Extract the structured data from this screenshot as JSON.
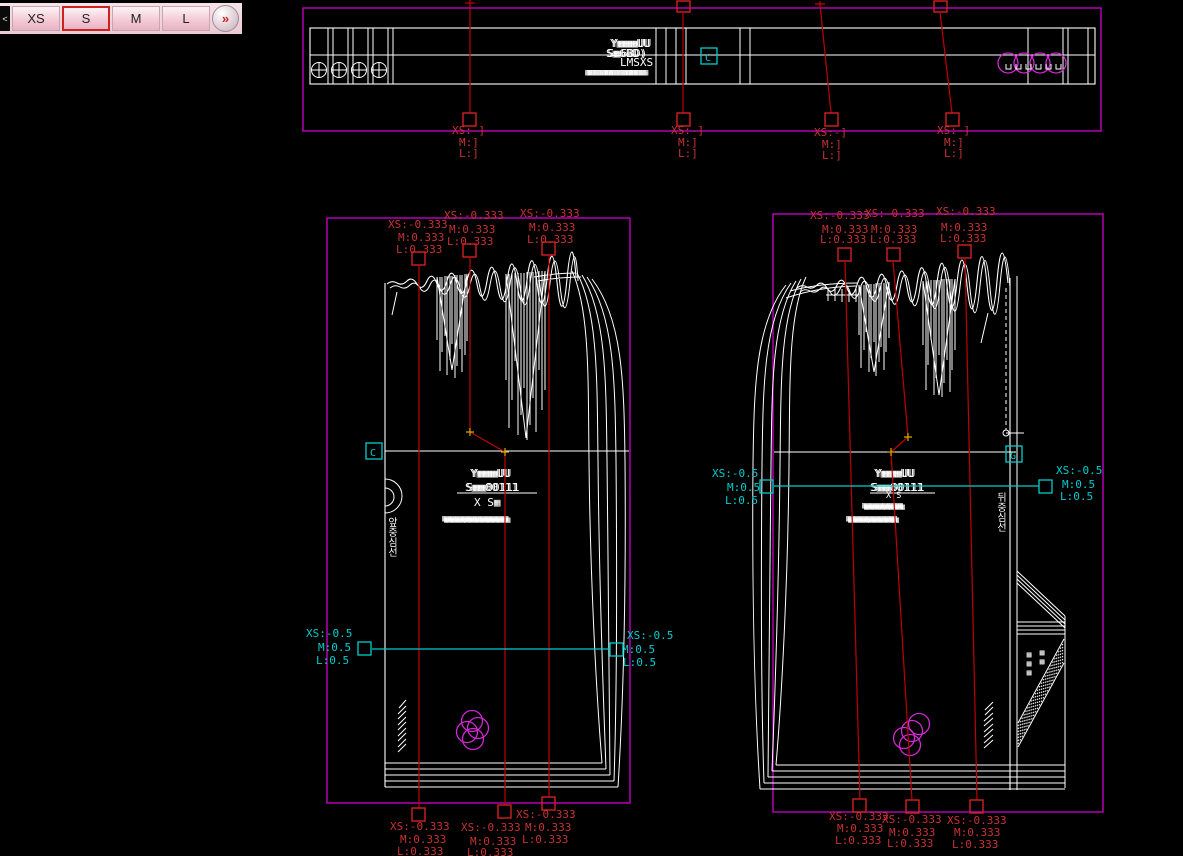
{
  "tabs": {
    "prev": "<",
    "items": [
      {
        "label": "XS",
        "selected": false
      },
      {
        "label": "S",
        "selected": true
      },
      {
        "label": "M",
        "selected": false
      },
      {
        "label": "L",
        "selected": false
      }
    ],
    "more": "»"
  },
  "colors": {
    "background": "#000000",
    "bounding_box_magenta": "#c000c0",
    "ring_magenta": "#d428d4",
    "grade_text_red": "#c83232",
    "grade_line_red": "#c00000",
    "measure_cyan": "#00cdcd",
    "outline_white": "#ffffff",
    "selected_tab_border": "#cc2222"
  },
  "band": {
    "labels": [
      "Y▦▦▦UU",
      "S▦6BD)",
      "LMSXS",
      "▦▦▦▦▦▦▦▦▦▦▦▦"
    ],
    "marker_glyph": "C",
    "grades": [
      {
        "xs": "XS:-]",
        "m": "M:]",
        "l": "L:]"
      },
      {
        "xs": "XS:-]",
        "m": "M:]",
        "l": "L:]"
      },
      {
        "xs": "XS:-]",
        "m": "M:]",
        "l": "L:]"
      },
      {
        "xs": "XS:-]",
        "m": "M:]",
        "l": "L:]"
      }
    ]
  },
  "front": {
    "top_grades": [
      {
        "xs": "XS:-0.333",
        "m": "M:0.333",
        "l": "L:0.333"
      },
      {
        "xs": "XS:-0.333",
        "m": "M:0.333",
        "l": "L:0.333"
      },
      {
        "xs": "XS:-0.333",
        "m": "M:0.333",
        "l": "L:0.333"
      }
    ],
    "bottom_grades": [
      {
        "xs": "XS:-0.333",
        "m": "M:0.333",
        "l": "L:0.333"
      },
      {
        "xs": "XS:-0.333",
        "m": "M:0.333",
        "l": "L:0.333"
      },
      {
        "xs": "XS:-0.333",
        "m": "M:0.333",
        "l": "L:0.333"
      }
    ],
    "left_grade": {
      "xs": "XS:-0.5",
      "m": "M:0.5",
      "l": "L:0.5"
    },
    "right_grade": {
      "xs": "XS:-0.5",
      "m": "M:0.5",
      "l": "L:0.5"
    },
    "labels": [
      "Y▦▦▦UU",
      "S▦▦00111",
      "X S▦",
      "▦▦▦▦▦▦▦▦▦▦▦▦▦"
    ],
    "fold_label": "앞중심선",
    "marker_glyph": "C"
  },
  "back": {
    "top_grades": [
      {
        "xs": "XS:-0.333",
        "m": "M:0.333",
        "l": "L:0.333"
      },
      {
        "xs": "XS:-0.333",
        "m": "M:0.333",
        "l": "L:0.333"
      },
      {
        "xs": "XS:-0.333",
        "m": "M:0.333",
        "l": "L:0.333"
      }
    ],
    "bottom_grades": [
      {
        "xs": "XS:-0.333",
        "m": "M:0.333",
        "l": "L:0.333"
      },
      {
        "xs": "XS:-0.333",
        "m": "M:0.333",
        "l": "L:0.333"
      },
      {
        "xs": "XS:-0.333",
        "m": "M:0.333",
        "l": "L:0.333"
      }
    ],
    "left_grade": {
      "xs": "XS:-0.5",
      "m": "M:0.5",
      "l": "L:0.5"
    },
    "right_grade": {
      "xs": "XS:-0.5",
      "m": "M:0.5",
      "l": "L:0.5"
    },
    "labels": [
      "Y▦▦▦UU",
      "S▦▦00111",
      "X S",
      "▦▦▦▦▦▦▦▦",
      "▦▦▦▦▦▦▦▦▦▦"
    ],
    "cb_label": "뒤중심선",
    "vent_labels": [
      "▦▦▦",
      "▦▦"
    ],
    "marker_glyph": "G"
  }
}
